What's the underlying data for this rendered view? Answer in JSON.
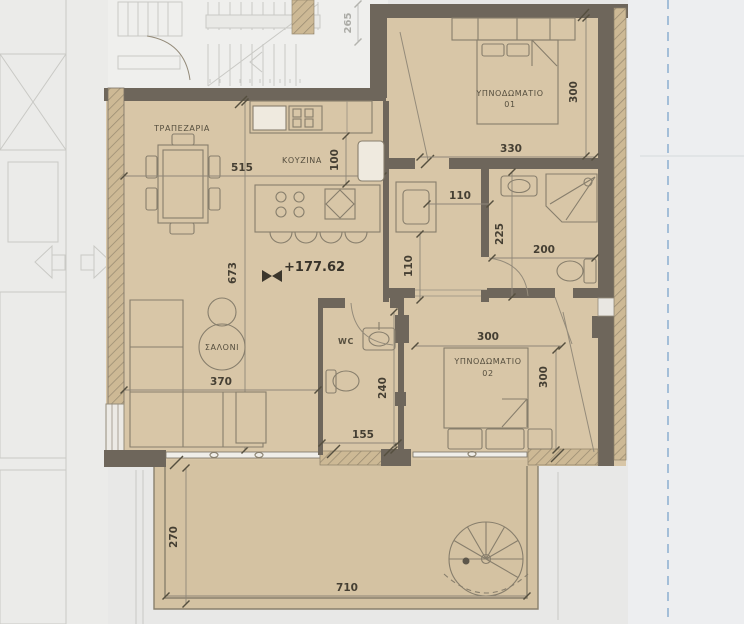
{
  "plan": {
    "rooms": {
      "dining": "ΤΡΑΠΕΖΑΡΙΑ",
      "kitchen": "ΚΟΥΖΙΝΑ",
      "living": "ΣΑΛΟΝΙ",
      "wc": "WC",
      "bedroom1_name": "ΥΠΝΟΔΩΜΑΤΙΟ",
      "bedroom1_no": "01",
      "bedroom2_name": "ΥΠΝΟΔΩΜΑΤΙΟ",
      "bedroom2_no": "02"
    },
    "level_marker": "+177.62",
    "dims": {
      "dining_width": "515",
      "kitchen_gap": "100",
      "dining_depth": "673",
      "living_width": "370",
      "hall_width": "110",
      "hall_depth": "110",
      "bath_depth": "225",
      "bath_width": "200",
      "wc_depth": "240",
      "wc_width": "155",
      "bed1_width": "330",
      "bed1_depth": "300",
      "bed2_width": "300",
      "bed2_depth": "300",
      "terrace_depth": "270",
      "terrace_width": "710",
      "stair_run": "265"
    },
    "colors": {
      "floor": "#d8c6a7",
      "wall": "#6e665b",
      "background": "#e8e8e7",
      "boundary": "#84a9ce"
    }
  }
}
